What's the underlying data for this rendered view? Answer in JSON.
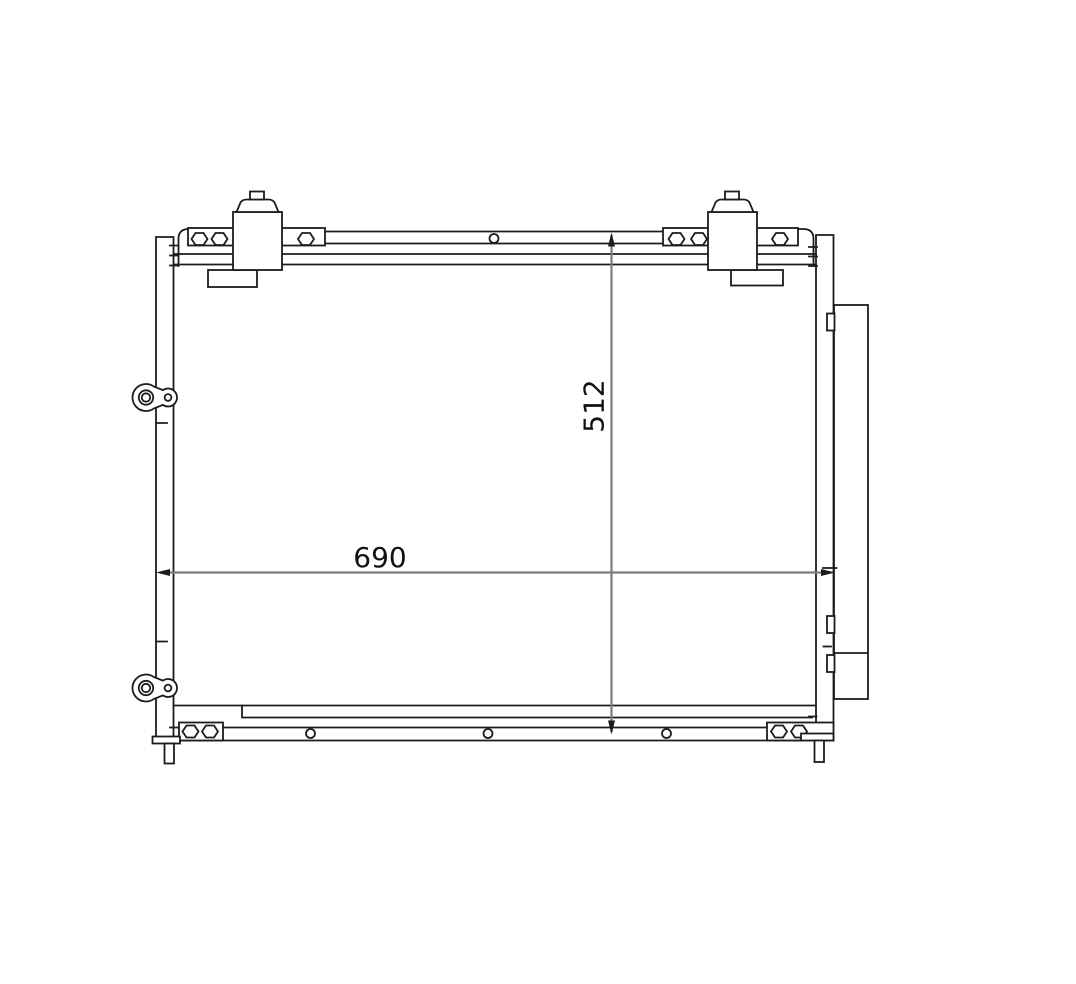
{
  "page": {
    "background_color": "#ffffff",
    "width_px": 1076,
    "height_px": 984
  },
  "drawing": {
    "type": "technical-line-drawing",
    "subject": "ac-condenser-front-view",
    "line_color": "#1c1c1c",
    "dimension_line_color": "#7d7d7d",
    "label_color": "#111111",
    "dimensions": {
      "width": {
        "value": "690",
        "orientation": "horizontal"
      },
      "height": {
        "value": "512",
        "orientation": "vertical"
      }
    },
    "components": [
      "top-mounting-rail",
      "top-left-fitting-block",
      "top-right-fitting-block",
      "left-header-tank",
      "right-header-tank",
      "condenser-core",
      "receiver-drier",
      "upper-grommet-mount",
      "lower-grommet-mount",
      "bottom-mounting-rail",
      "bottom-left-bracket",
      "bottom-right-bracket",
      "left-mounting-pin",
      "right-mounting-pin"
    ]
  }
}
